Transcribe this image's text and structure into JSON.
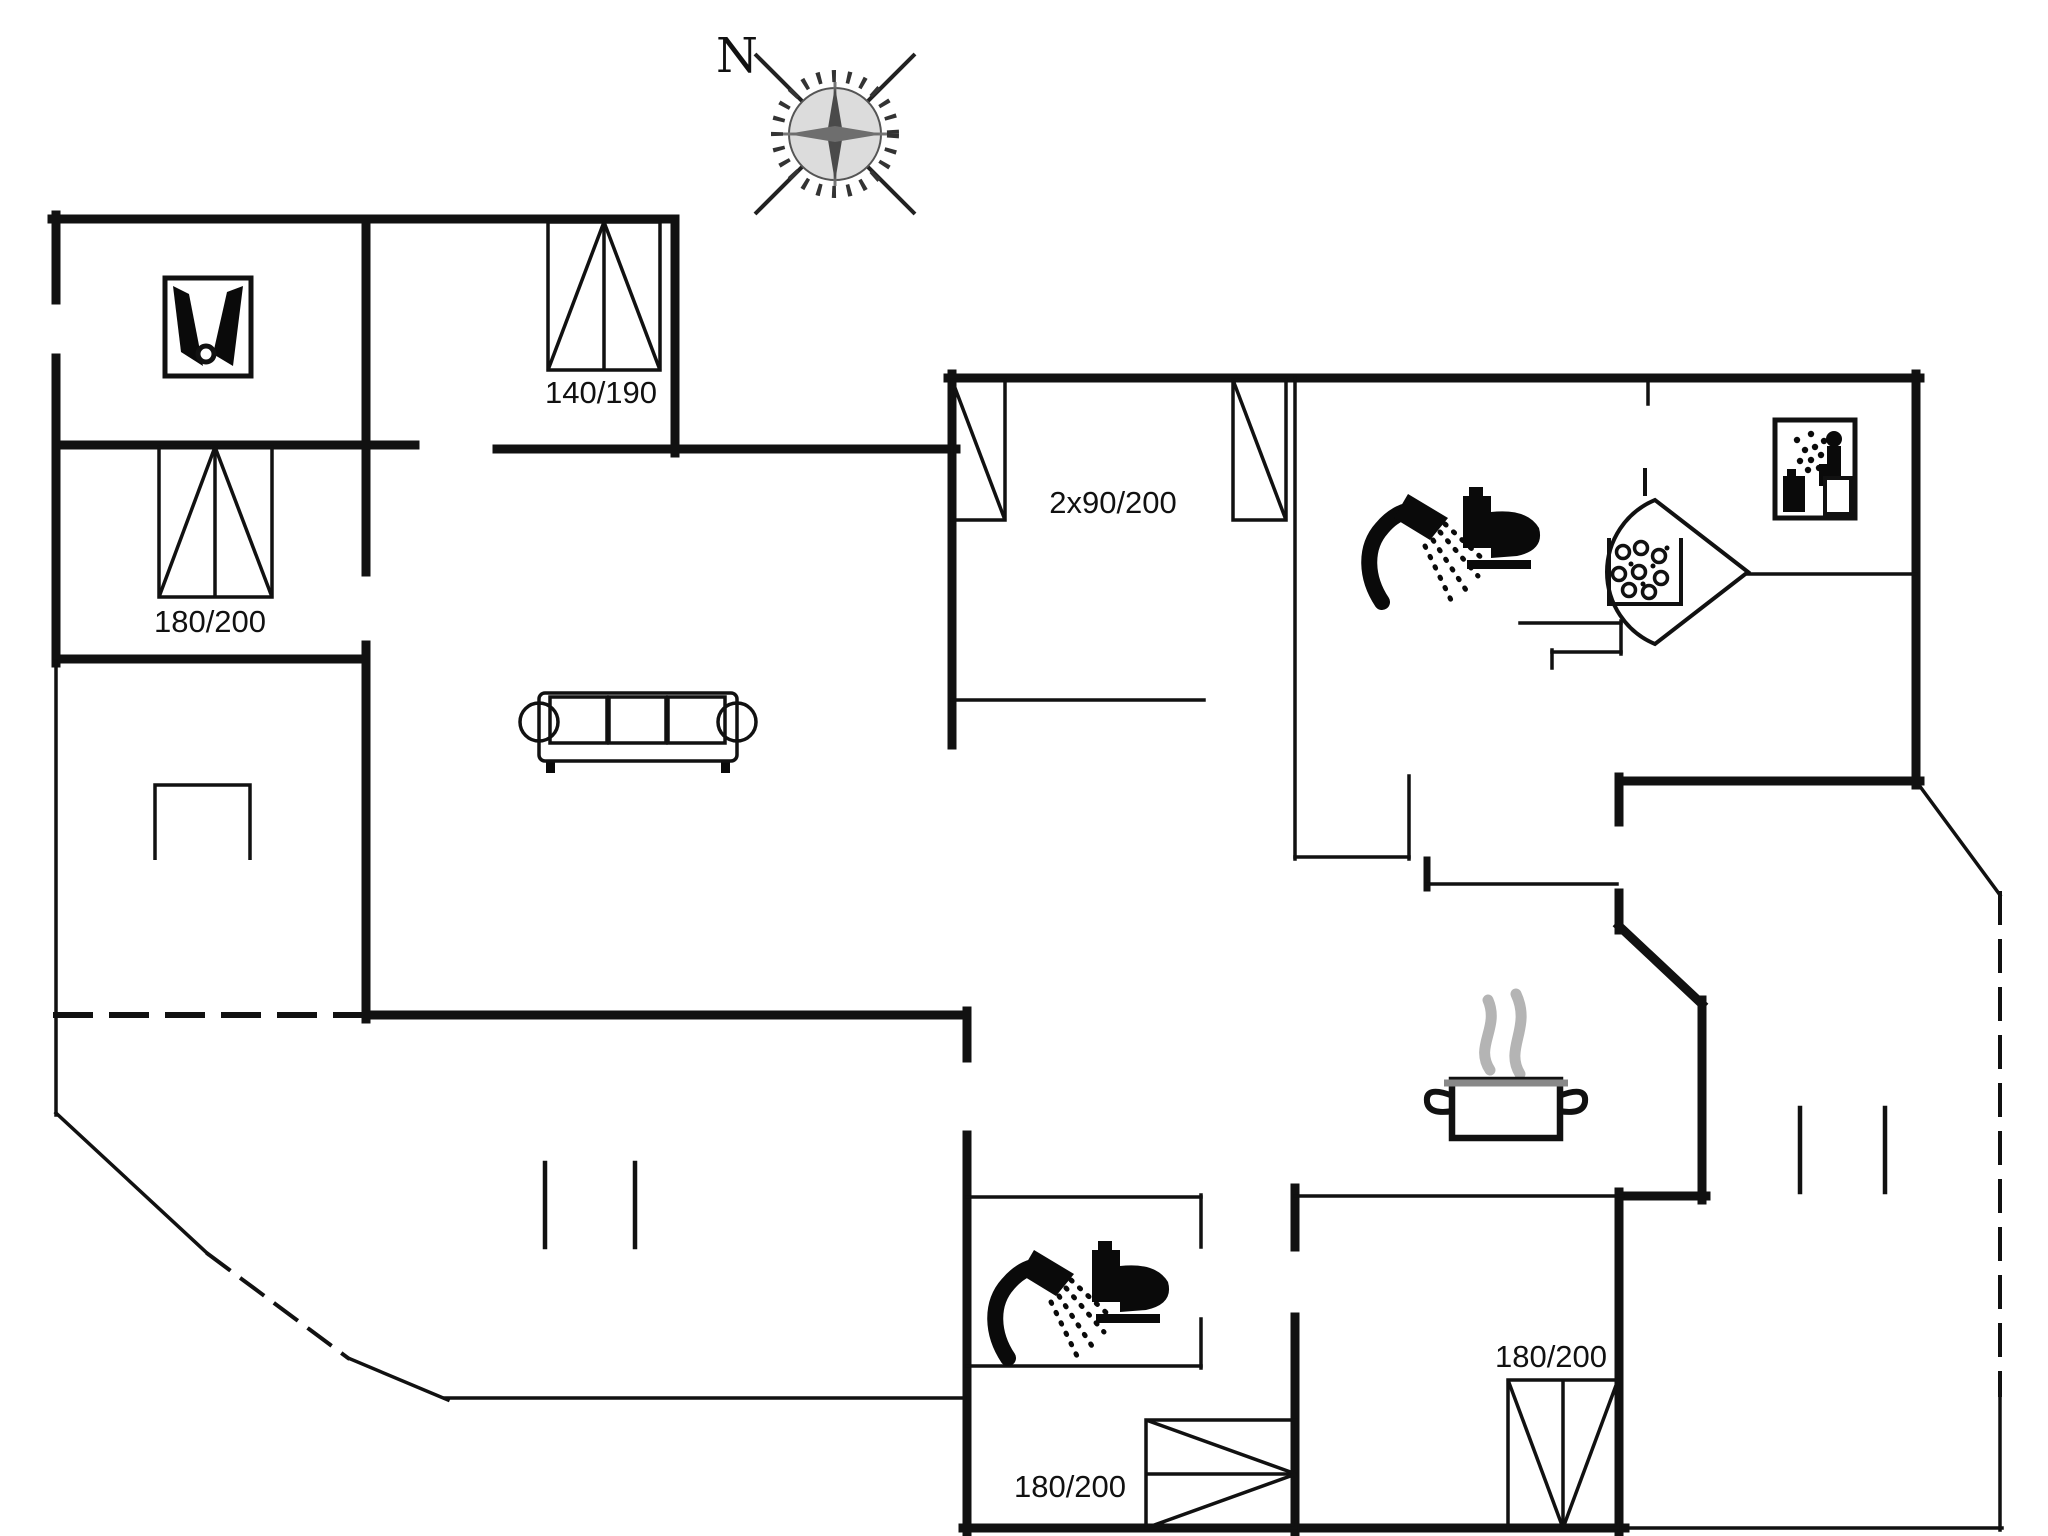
{
  "compass": {
    "north_label": "N"
  },
  "labels": {
    "bed_140x190": "140/190",
    "bed_180x200_upper_left": "180/200",
    "bed_2x90x200": "2x90/200",
    "bed_180x200_lower_middle": "180/200",
    "bed_180x200_lower_right": "180/200"
  },
  "colors": {
    "wall": "#111111",
    "icon": "#0a0a0a",
    "steam_gray": "#b4b4b4",
    "background": "#ffffff"
  },
  "icons": [
    {
      "name": "compass-rose-icon"
    },
    {
      "name": "wardrobe-icon"
    },
    {
      "name": "double-bed-icon"
    },
    {
      "name": "single-bed-icon"
    },
    {
      "name": "sofa-icon"
    },
    {
      "name": "shower-icon"
    },
    {
      "name": "toilet-icon"
    },
    {
      "name": "sauna-stove-icon"
    },
    {
      "name": "sauna-icon"
    },
    {
      "name": "cooking-pot-icon"
    },
    {
      "name": "fireplace-icon"
    }
  ]
}
